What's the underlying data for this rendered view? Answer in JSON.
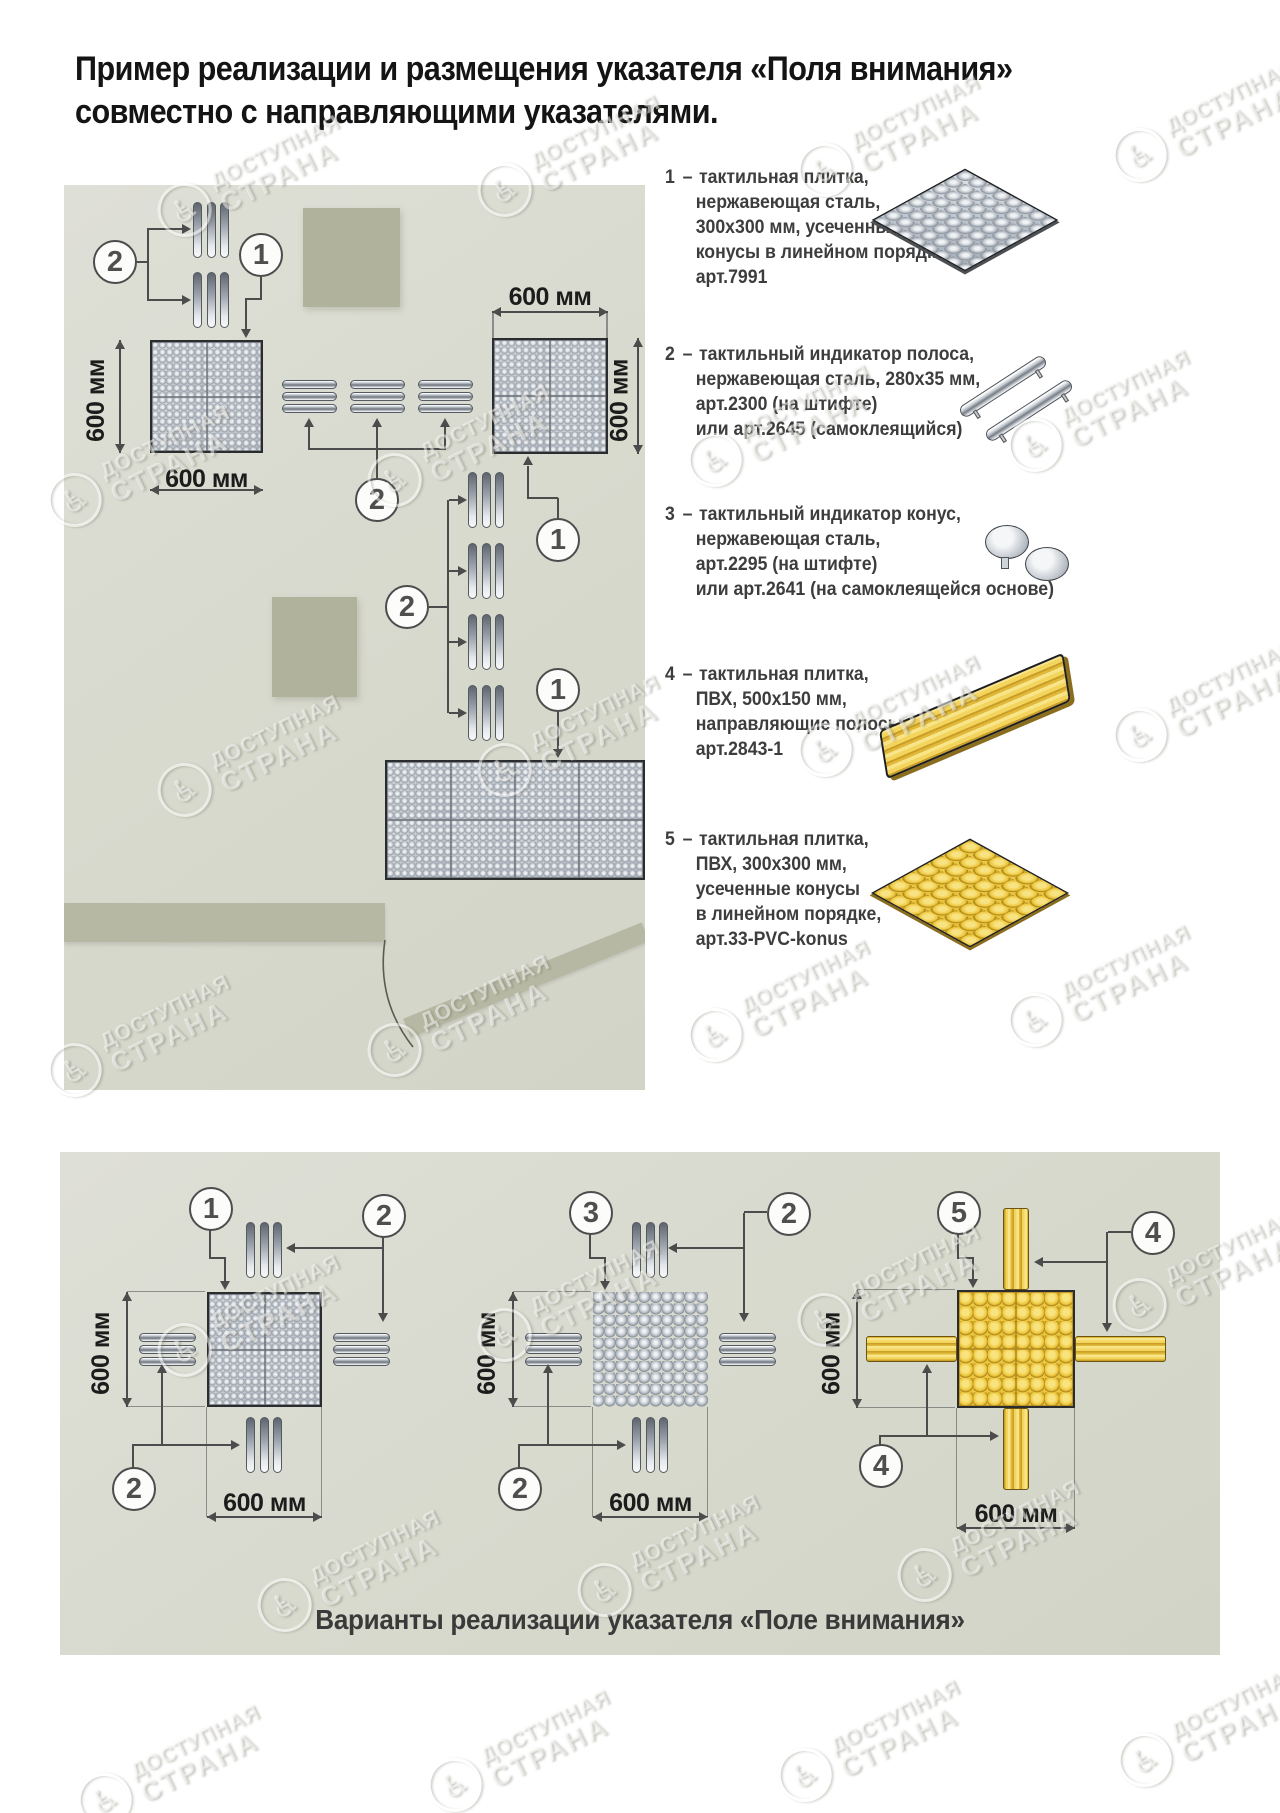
{
  "title": {
    "line1": "Пример реализации и размещения указателя «Поля внимания»",
    "line2": "совместно с направляющими указателями."
  },
  "dims": {
    "label": "600 мм"
  },
  "markers": {
    "m1": "1",
    "m2": "2",
    "m3": "3",
    "m4": "4",
    "m5": "5"
  },
  "legend": {
    "sep": "–",
    "items": [
      {
        "num": "1",
        "icon": "steel-tile-icon",
        "lines": [
          "тактильная плитка,",
          "нержавеющая сталь,",
          "300х300 мм, усеченные",
          "конусы в линейном порядке,",
          "арт.7991"
        ]
      },
      {
        "num": "2",
        "icon": "steel-strip-icon",
        "lines": [
          "тактильный индикатор полоса,",
          "нержавеющая сталь, 280х35 мм,",
          "арт.2300 (на штифте)",
          "или арт.2645 (самоклеящийся)"
        ]
      },
      {
        "num": "3",
        "icon": "steel-cone-icon",
        "lines": [
          "тактильный индикатор конус,",
          "нержавеющая сталь,",
          "арт.2295 (на штифте)",
          "или арт.2641 (на самоклеящейся основе)"
        ]
      },
      {
        "num": "4",
        "icon": "pvc-guide-tile-icon",
        "lines": [
          "тактильная плитка,",
          "ПВХ, 500х150 мм,",
          "направляющие полосы,",
          "арт.2843-1"
        ]
      },
      {
        "num": "5",
        "icon": "pvc-cone-tile-icon",
        "lines": [
          "тактильная плитка,",
          "ПВХ, 300х300 мм,",
          "усеченные конусы",
          "в линейном порядке,",
          "арт.33-PVC-konus"
        ]
      }
    ]
  },
  "caption": "Варианты реализации указателя «Поле внимания»",
  "watermark": {
    "symbol": "♿",
    "line1": "ДОСТУПНАЯ",
    "line2": "СТРАНА"
  },
  "colors": {
    "panel_bg": "#d8d9cf",
    "olive": "#b1b29b",
    "wall": "#b7b8a3",
    "steel": "#aeb5be",
    "yellow": "#eec737",
    "line": "#4c4c4c"
  }
}
